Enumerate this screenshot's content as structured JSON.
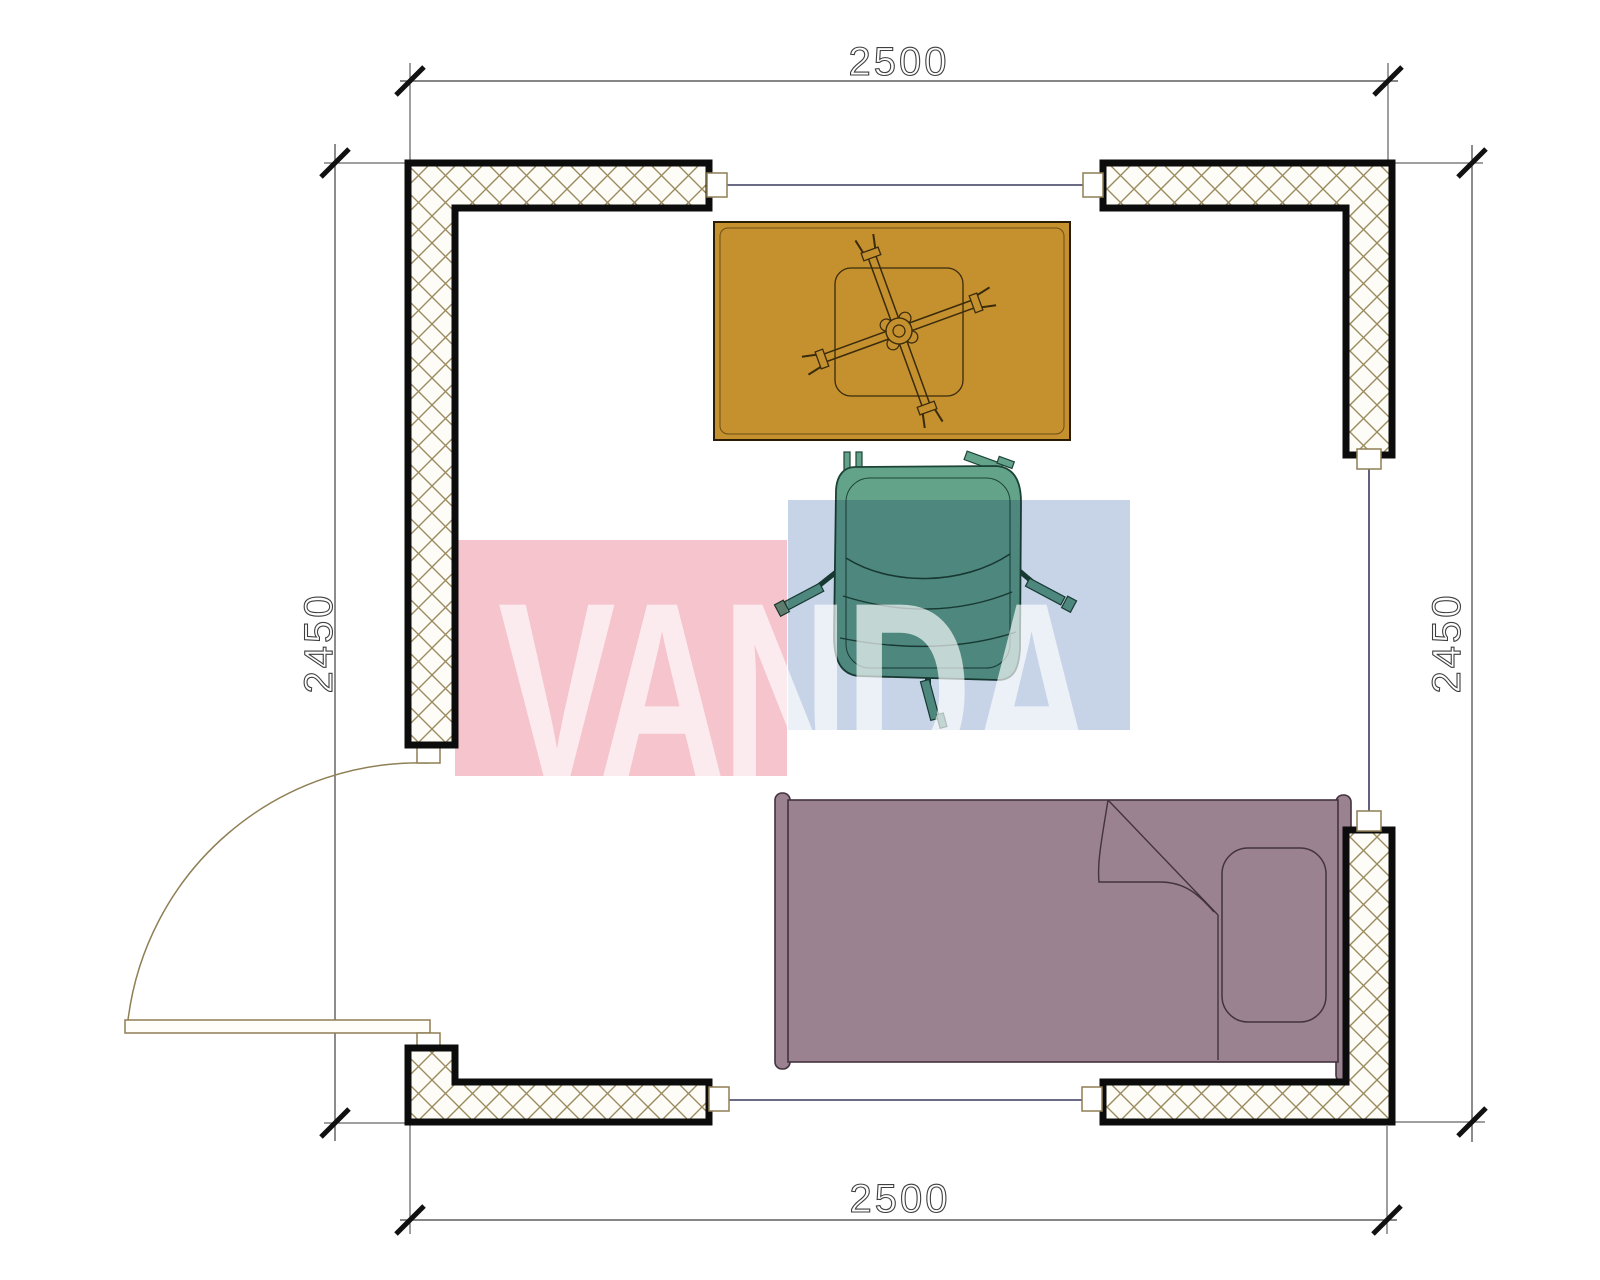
{
  "dims": {
    "top": "2500",
    "bottom": "2500",
    "left": "2450",
    "right": "2450"
  },
  "watermark": {
    "text": "VANDA"
  },
  "colors": {
    "dim-line": "#3f3f3f",
    "wall-hatch-line": "#9a8a5e",
    "wall-hatch-bg": "#fdfcf6",
    "window-line": "#3a3a5e",
    "door-line": "#8f7f55",
    "table-fill": "#c5912f",
    "table-line": "#3a2b0c",
    "chair-fill": "#63a38a",
    "chair-line": "#1d4437",
    "bed-fill": "#9b8290",
    "bed-line": "#43323f",
    "wm-pink": "#f5c4cd",
    "wm-blue": "#c7d4e8",
    "wm-text": "rgba(255,255,255,0.66)"
  },
  "items": {
    "room": "single room plan",
    "furniture": [
      "table",
      "office-chair",
      "single-bed"
    ],
    "openings": [
      "door-left",
      "window-top",
      "window-right",
      "window-bottom"
    ]
  }
}
